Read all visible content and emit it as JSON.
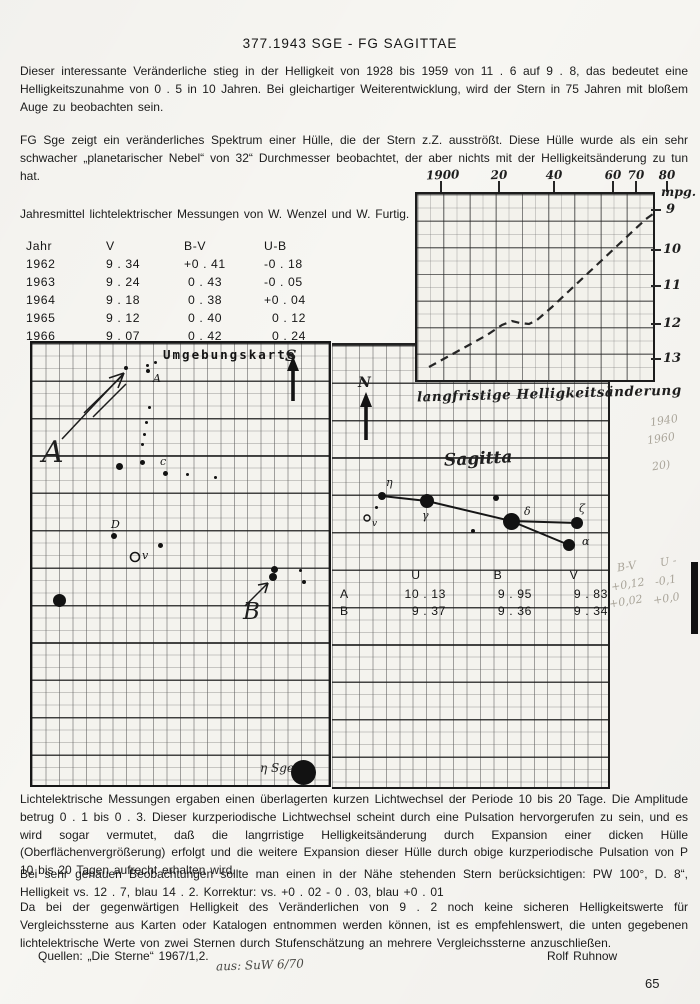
{
  "doc": {
    "title": "377.1943 SGE - FG SAGITTAE",
    "para1": "Dieser interessante Veränderliche stieg in der Helligkeit von 1928 bis 1959 von 11 . 6 auf 9 . 8, das bedeutet eine Helligkeitszunahme von 0 . 5 in 10 Jahren. Bei gleichartiger Weiterentwicklung, wird der Stern in 75 Jahren mit bloßem Auge zu beobachten sein.",
    "para2": "FG Sge zeigt ein veränderliches Spektrum einer Hülle, die der Stern z.Z. ausströßt. Diese Hülle wurde als ein sehr schwacher „planetarischer Nebel“ von 32“ Durchmesser beobachtet, der aber nichts mit der Helligkeitsänderung zu tun hat.",
    "measurements_intro": "Jahresmittel lichtelektrischer Messungen von W. Wenzel und W. Furtig.",
    "para_photometric": "Lichtelektrische Messungen ergaben einen überlagerten kurzen Lichtwechsel der Periode 10 bis 20 Tage. Die Amplitude betrug 0 . 1 bis 0 . 3. Dieser kurzperiodische Lichtwechsel scheint durch eine Pulsation hervorgerufen zu sein, und es wird sogar vermutet, daß die langrristige Helligkeitsänderung durch Expansion einer dicken Hülle (Oberflächenvergrößerung) erfolgt und die weitere Expansion dieser Hülle durch obige kurzperiodische Pulsation von P 10 bis 20 Tagen aufrecht erhalten wird.",
    "para_neighbor": "Bei sehr genauen Beobachtungen sollte man einen in der Nähe stehenden Stern berücksichtigen: PW  100°, D.  8“, Helligkeit vs. 12 . 7, blau 14 . 2. Korrektur: vs. +0 . 02 - 0 . 03, blau +0 . 01",
    "para_comparison": "Da bei der gegenwärtigen Helligkeit des Veränderlichen von 9 . 2 noch keine sicheren Helligkeitswerte für Vergleichssterne aus Karten oder Katalogen entnommen werden können, ist es empfehlenswert, die unten gegebenen lichtelektrische Werte von zwei Sternen durch Stufenschätzung an mehrere Vergleichssterne anzuschließen.",
    "sources_label": "Quellen: „Die Sterne“ 1967/1,2.",
    "author": "Rolf Ruhnow",
    "handwritten_source": "aus:  SuW  6/70",
    "page_number": "65"
  },
  "yearly_table": {
    "headers": [
      "Jahr",
      "V",
      "B-V",
      "U-B"
    ],
    "col_lefts": [
      26,
      106,
      184,
      264
    ],
    "rows": [
      [
        "1962",
        "9 . 34",
        "+0 . 41",
        "-0 . 18"
      ],
      [
        "1963",
        "9 . 24",
        " 0 . 43",
        "-0 . 05"
      ],
      [
        "1964",
        "9 . 18",
        " 0 . 38",
        "+0 . 04"
      ],
      [
        "1965",
        "9 . 12",
        " 0 . 40",
        "  0 . 12"
      ],
      [
        "1966",
        "9 . 07",
        " 0 . 42",
        "  0 . 24"
      ]
    ]
  },
  "chart_data": {
    "type": "line",
    "caption": "langfristige Helligkeitsänderung",
    "y_unit_label": "mpg.",
    "line_style": "dashed",
    "x_range": [
      1896,
      1981
    ],
    "y_range": [
      13.5,
      8.6
    ],
    "x_ticks": [
      {
        "label": "1900",
        "x": 33
      },
      {
        "label": "20",
        "x": 91
      },
      {
        "label": "40",
        "x": 146
      },
      {
        "label": "60",
        "x": 205
      },
      {
        "label": "70",
        "x": 228
      },
      {
        "label": "80",
        "x": 259
      }
    ],
    "y_ticks": [
      {
        "label": "9",
        "y": 36
      },
      {
        "label": "10",
        "y": 76
      },
      {
        "label": "11",
        "y": 112
      },
      {
        "label": "12",
        "y": 150
      },
      {
        "label": "13",
        "y": 185
      }
    ],
    "series": [
      {
        "name": "mpg",
        "points": [
          [
            1901,
            13.2
          ],
          [
            1908,
            12.9
          ],
          [
            1915,
            12.6
          ],
          [
            1922,
            12.3
          ],
          [
            1927,
            12.1
          ],
          [
            1931,
            12.0
          ],
          [
            1934,
            12.0
          ],
          [
            1937,
            12.05
          ],
          [
            1940,
            11.95
          ],
          [
            1945,
            11.6
          ],
          [
            1951,
            11.1
          ],
          [
            1957,
            10.7
          ],
          [
            1963,
            10.3
          ],
          [
            1968,
            9.9
          ],
          [
            1974,
            9.5
          ],
          [
            1981,
            9.1
          ]
        ]
      }
    ],
    "points_px": [
      [
        12,
        173
      ],
      [
        32,
        162
      ],
      [
        52,
        151
      ],
      [
        70,
        141
      ],
      [
        85,
        131
      ],
      [
        95,
        127
      ],
      [
        103,
        129
      ],
      [
        112,
        130
      ],
      [
        120,
        126
      ],
      [
        135,
        113
      ],
      [
        152,
        97
      ],
      [
        168,
        82
      ],
      [
        184,
        67
      ],
      [
        200,
        52
      ],
      [
        216,
        37
      ],
      [
        229,
        25
      ],
      [
        236,
        20
      ]
    ]
  },
  "environment_map": {
    "title": "Umgebungskarte",
    "south_label": "S",
    "pointer_a_label": "A",
    "pointer_b_label": "B",
    "eta_sge_label": "η Sge",
    "variable_marker": {
      "x": 103,
      "y": 214,
      "label": "v"
    },
    "stars": [
      {
        "x": 94,
        "y": 25,
        "r": 2
      },
      {
        "x": 115,
        "y": 22,
        "r": 1.5
      },
      {
        "x": 116,
        "y": 28,
        "r": 2,
        "label": "A",
        "lx": 121,
        "ly": 29
      },
      {
        "x": 123,
        "y": 19,
        "r": 1.5
      },
      {
        "x": 117,
        "y": 64,
        "r": 1.5
      },
      {
        "x": 114,
        "y": 79,
        "r": 1.5
      },
      {
        "x": 112,
        "y": 91,
        "r": 1.5
      },
      {
        "x": 110,
        "y": 101,
        "r": 1.5
      },
      {
        "x": 87,
        "y": 123,
        "r": 3.5
      },
      {
        "x": 110,
        "y": 119,
        "r": 2.5
      },
      {
        "x": 133,
        "y": 130,
        "r": 2.5,
        "label": "c",
        "lx": 128,
        "ly": 112
      },
      {
        "x": 155,
        "y": 131,
        "r": 1.5
      },
      {
        "x": 183,
        "y": 134,
        "r": 1.5
      },
      {
        "x": 82,
        "y": 193,
        "r": 3,
        "label": "D",
        "lx": 79,
        "ly": 175
      },
      {
        "x": 128,
        "y": 202,
        "r": 2.5
      },
      {
        "x": 242,
        "y": 226,
        "r": 3.5
      },
      {
        "x": 241,
        "y": 234,
        "r": 4
      },
      {
        "x": 268,
        "y": 227,
        "r": 1.5
      },
      {
        "x": 272,
        "y": 239,
        "r": 2
      },
      {
        "x": 27,
        "y": 257,
        "r": 6.5
      },
      {
        "x": 271,
        "y": 429,
        "r": 12.5
      }
    ]
  },
  "sagitta_map": {
    "north_label": "N",
    "title": "Sagitta",
    "variable_marker": {
      "x": 35,
      "y": 173,
      "label": "v"
    },
    "stars": [
      {
        "x": 50,
        "y": 151,
        "r": 4,
        "label": "η",
        "lx": 54,
        "ly": 131
      },
      {
        "x": 44,
        "y": 162,
        "r": 1.5
      },
      {
        "x": 95,
        "y": 156,
        "r": 7,
        "label": "γ",
        "lx": 90,
        "ly": 164
      },
      {
        "x": 164,
        "y": 153,
        "r": 3
      },
      {
        "x": 179,
        "y": 176,
        "r": 8.5,
        "label": "δ",
        "lx": 192,
        "ly": 160
      },
      {
        "x": 141,
        "y": 186,
        "r": 2
      },
      {
        "x": 245,
        "y": 178,
        "r": 6,
        "label": "ζ",
        "lx": 247,
        "ly": 157
      },
      {
        "x": 237,
        "y": 200,
        "r": 6,
        "label": "α",
        "lx": 250,
        "ly": 190
      }
    ],
    "lines": [
      [
        50,
        151,
        95,
        156
      ],
      [
        95,
        156,
        179,
        176
      ],
      [
        179,
        176,
        245,
        178
      ],
      [
        179,
        176,
        237,
        200
      ]
    ]
  },
  "uvb_table": {
    "headers": [
      "U",
      "B",
      "V"
    ],
    "header_centers": [
      84,
      166,
      242
    ],
    "value_right_edges": [
      114,
      200,
      276
    ],
    "rows": [
      {
        "label": "A",
        "values": [
          "10 . 13",
          "9 . 95",
          "9 . 83"
        ]
      },
      {
        "label": "B",
        "values": [
          "9 . 37",
          "9 . 36",
          "9 . 34"
        ]
      }
    ]
  },
  "pencil_notes": [
    {
      "x": 650,
      "y": 414,
      "text": "1940"
    },
    {
      "x": 647,
      "y": 432,
      "text": "1960"
    },
    {
      "x": 652,
      "y": 459,
      "text": "20)"
    },
    {
      "x": 617,
      "y": 560,
      "text": "B-V"
    },
    {
      "x": 660,
      "y": 555,
      "text": "U -"
    },
    {
      "x": 611,
      "y": 578,
      "text": "+0,12"
    },
    {
      "x": 655,
      "y": 574,
      "text": "-0,1"
    },
    {
      "x": 609,
      "y": 595,
      "text": "+0,02"
    },
    {
      "x": 653,
      "y": 592,
      "text": "+0,0"
    }
  ]
}
